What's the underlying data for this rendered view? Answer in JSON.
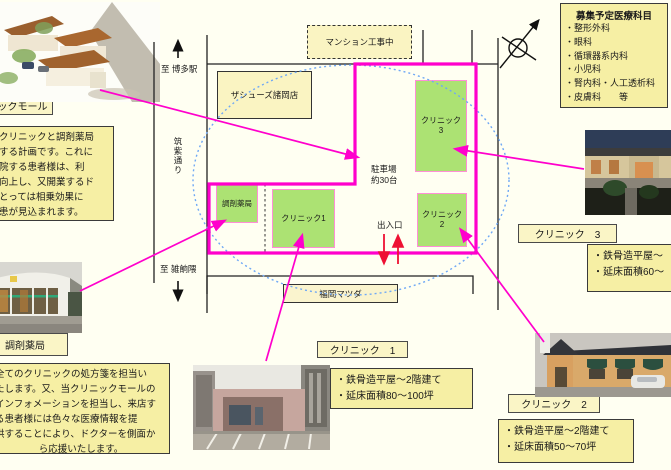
{
  "recruit": {
    "title": "募集予定医療科目",
    "items": [
      "・整形外科",
      "・眼科",
      "・循環器系内科",
      "・小児科",
      "・腎内科・人工透析科",
      "・皮膚科　　等"
    ]
  },
  "map": {
    "construction": "マンション工事中",
    "shoes_store": "ザシューズ諸岡店",
    "mazda": "福岡マツダ",
    "to_hakata": "至 博多駅",
    "chikushi_street": "筑紫通り",
    "to_zasshonokuma": "至 雑餉隈",
    "parking_line1": "駐車場",
    "parking_line2": "約30台",
    "entrance": "出入口",
    "pharmacy": "調剤薬局",
    "clinic1": "クリニック1",
    "clinic2_l1": "クリニック",
    "clinic2_l2": "2",
    "clinic3_l1": "クリニック",
    "clinic3_l2": "3"
  },
  "labels": {
    "mall": "クリニックモール",
    "pharmacy": "調剤薬局",
    "clinic1": "クリニック　1",
    "clinic2": "クリニック　2",
    "clinic3": "クリニック　3"
  },
  "intro_box": {
    "lines": [
      "クリニックと調剤薬局",
      "する計画です。これに",
      "院する患者様は、利",
      "向上し、又開業するド",
      "とっては相乗効果に",
      "患が見込まれます。"
    ]
  },
  "pharmacy_box": {
    "lines": [
      "全てのクリニックの処方箋を担当い",
      "たします。又、当クリニックモールの",
      "インフォメーションを担当し、来店す",
      "る患者様には色々な医療情報を提",
      "供することにより、ドクターを側面か",
      "ら応援いたします。"
    ]
  },
  "specs": {
    "clinic1": [
      "・鉄骨造平屋～2階建て",
      "・延床面積80～100坪"
    ],
    "clinic2": [
      "・鉄骨造平屋～2階建て",
      "・延床面積50～70坪"
    ],
    "clinic3": [
      "・鉄骨造平屋～",
      "・延床面積60～"
    ]
  },
  "colors": {
    "site_outline": "#FF00CC",
    "annotation": "#FF00CC",
    "entrance_arrows": "#EE1133",
    "catchment_ellipse": "#6FA8F5",
    "green_building": "#ACE273",
    "info_box_bg": "#F6EFA4"
  }
}
